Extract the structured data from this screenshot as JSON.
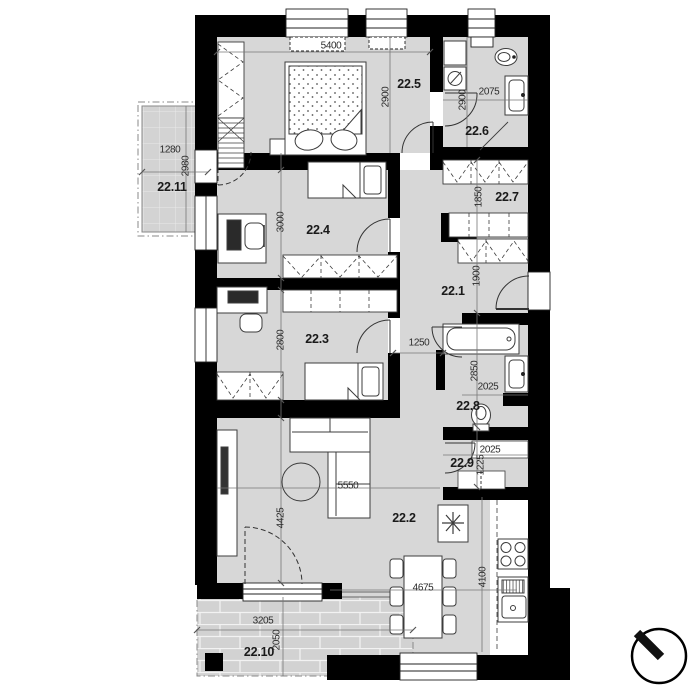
{
  "rooms": {
    "r1": "22.1",
    "r2": "22.2",
    "r3": "22.3",
    "r4": "22.4",
    "r5": "22.5",
    "r6": "22.6",
    "r7": "22.7",
    "r8": "22.8",
    "r9": "22.9",
    "r10": "22.10",
    "r11": "22.11"
  },
  "dims": {
    "d5400": "5400",
    "d2900_bedroom": "2900",
    "d2900_bath": "2900",
    "d2075": "2075",
    "d1280": "1280",
    "d2980": "2980",
    "d3000": "3000",
    "d1850": "1850",
    "d1900": "1900",
    "d2800": "2800",
    "d1250": "1250",
    "d2850": "2850",
    "d2025_bath": "2025",
    "d2025_storage": "2025",
    "d1225": "1225",
    "d5550": "5550",
    "d4425": "4425",
    "d4675": "4675",
    "d4100": "4100",
    "d3205": "3205",
    "d2050": "2050"
  },
  "colors": {
    "wall": "#000000",
    "floor": "#d7d7d7",
    "balcony_floor": "#d3d3d3",
    "terrace_floor": "#d2d2d2",
    "furniture_stroke": "#3c3c3c",
    "dim_line": "#777777",
    "text": "#1a1a1a"
  },
  "icons": [
    "double-bed",
    "single-bed",
    "wardrobe",
    "dresser",
    "desk",
    "office-chair",
    "sofa",
    "coffee-table",
    "tv",
    "dining-table",
    "chair",
    "bathtub",
    "washbasin",
    "toilet",
    "washing-machine",
    "fridge-snowflake",
    "stove",
    "kitchen-sink",
    "north-arrow"
  ]
}
